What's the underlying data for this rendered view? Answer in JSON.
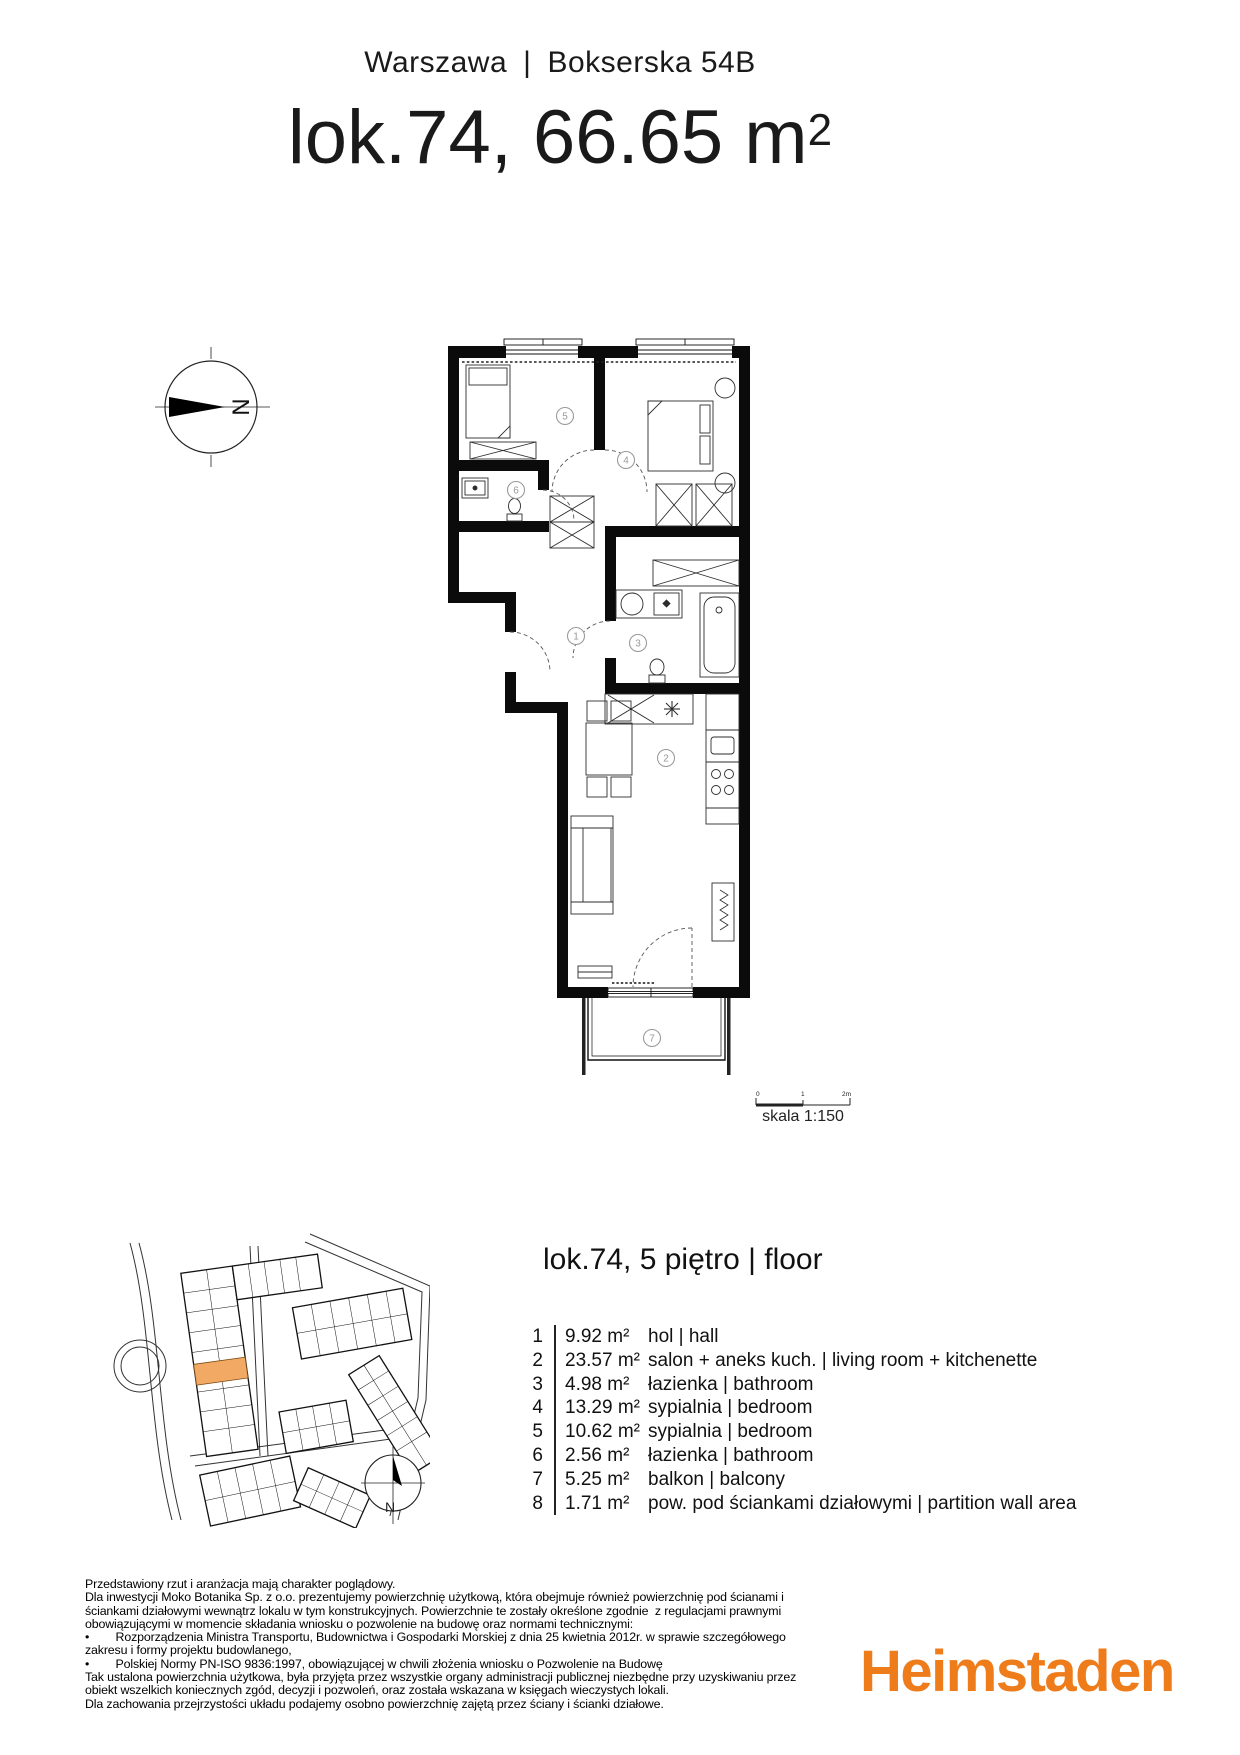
{
  "header": {
    "city": "Warszawa",
    "separator": "|",
    "address": "Bokserska 54B",
    "title_main": "lok.74, 66.65 m",
    "title_sup": "2"
  },
  "plan": {
    "rooms": [
      "1",
      "2",
      "3",
      "4",
      "5",
      "6",
      "7"
    ],
    "compass_letter": "N",
    "scale": {
      "label": "skala 1:150",
      "tick0": "0",
      "tick1": "1",
      "tick2": "2m"
    }
  },
  "sitemap": {
    "compass_letter": "N",
    "highlight_color": "#F2A963"
  },
  "unit_section": {
    "title": "lok.74, 5 piętro | floor"
  },
  "legend": {
    "rows": [
      {
        "no": "1",
        "area": "9.92 m²",
        "name": "hol | hall"
      },
      {
        "no": "2",
        "area": "23.57 m²",
        "name": "salon + aneks kuch. | living room + kitchenette"
      },
      {
        "no": "3",
        "area": "4.98 m²",
        "name": "łazienka | bathroom"
      },
      {
        "no": "4",
        "area": "13.29 m²",
        "name": "sypialnia | bedroom"
      },
      {
        "no": "5",
        "area": "10.62 m²",
        "name": "sypialnia | bedroom"
      },
      {
        "no": "6",
        "area": "2.56 m²",
        "name": "łazienka | bathroom"
      },
      {
        "no": "7",
        "area": "5.25 m²",
        "name": "balkon | balcony"
      },
      {
        "no": "8",
        "area": "1.71 m²",
        "name": "pow. pod ściankami działowymi | partition wall area"
      }
    ]
  },
  "disclaimer": {
    "lines": [
      "Przedstawiony rzut i aranżacja mają charakter poglądowy.",
      "Dla inwestycji Moko Botanika Sp. z o.o. prezentujemy powierzchnię użytkową, która obejmuje również powierzchnię pod ścianami i",
      "ściankami działowymi wewnątrz lokalu w tym konstrukcyjnych. Powierzchnie te zostały określone zgodnie  z regulacjami prawnymi",
      "obowiązującymi w momencie składania wniosku o pozwolenie na budowę oraz normami technicznymi:",
      "•        Rozporządzenia Ministra Transportu, Budownictwa i Gospodarki Morskiej z dnia 25 kwietnia 2012r. w sprawie szczegółowego",
      "zakresu i formy projektu budowlanego,",
      "•        Polskiej Normy PN-ISO 9836:1997, obowiązującej w chwili złożenia wniosku o Pozwolenie na Budowę",
      "Tak ustalona powierzchnia użytkowa, była przyjęta przez wszystkie organy administracji publicznej niezbędne przy uzyskiwaniu przez",
      "obiekt wszelkich koniecznych zgód, decyzji i pozwoleń, oraz została wskazana w księgach wieczystych lokali.",
      "Dla zachowania przejrzystości układu podajemy osobno powierzchnię zajętą przez ściany i ścianki działowe."
    ]
  },
  "footer": {
    "logo_text": "Heimstaden",
    "logo_color": "#EF7C1B"
  }
}
